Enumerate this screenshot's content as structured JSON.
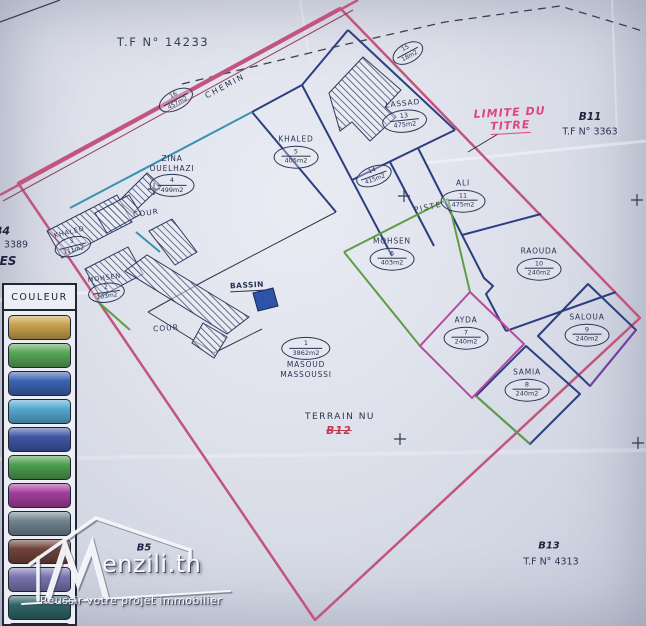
{
  "photo_labels": {
    "tf_main": "T.F N° 14233",
    "chemin": "CHEMIN",
    "limite_du_titre": [
      "LIMITE DU",
      "TITRE"
    ],
    "b11": "B11",
    "b11_tf": "T.F N° 3363",
    "b13": "B13",
    "b13_tf": "T.F N° 4313",
    "b5": "B5",
    "b4": "B4",
    "b4_tf": "3389",
    "left_partial": "ES",
    "piste": "PISTE",
    "cour_1": "COUR",
    "cour_2": "COUR",
    "bassin": "BASSIN",
    "terrain_nu": "TERRAIN NU",
    "b12": "B12"
  },
  "plots": [
    {
      "name": "",
      "number": "16",
      "area": "457m2"
    },
    {
      "name": "",
      "number": "15",
      "area": "18m2"
    },
    {
      "name": "LASSAD",
      "number": "13",
      "area": "475m2"
    },
    {
      "name": "",
      "number": "14",
      "area": "415m2"
    },
    {
      "name": "KHALED",
      "number": "5",
      "area": "405m2"
    },
    {
      "name": "ZINA",
      "name2": "OUELHAZI",
      "number": "4",
      "area": "499m2"
    },
    {
      "name": "ALI",
      "number": "11",
      "area": "475m2"
    },
    {
      "name": "RAOUDA",
      "number": "10",
      "area": "240m2"
    },
    {
      "name": "SALOUA",
      "number": "9",
      "area": "240m2"
    },
    {
      "name": "AYDA",
      "number": "7",
      "area": "240m2"
    },
    {
      "name": "SAMIA",
      "number": "8",
      "area": "240m2"
    },
    {
      "name": "MOHSEN",
      "number": "6",
      "area": "403m2"
    },
    {
      "name": "MASOUD",
      "name2": "MASSOUSSI",
      "number": "1",
      "area": "3862m2"
    },
    {
      "name": "KHALED",
      "number": "3",
      "area": "111m2"
    },
    {
      "name": "MOHSEN",
      "number": "2",
      "area": "103m2"
    }
  ],
  "legend": {
    "header": "COULEUR",
    "colors": [
      "#c8a24c",
      "#57a557",
      "#3c63b2",
      "#55a8cf",
      "#3f57a7",
      "#4d9d4f",
      "#a43e9d",
      "#70838f",
      "#6f4339",
      "#7a74b0",
      "#2f6668",
      "#275a3c"
    ]
  },
  "logo": {
    "brand_text": "enzili.tn",
    "slogan": "Réussir votre projet immobilier"
  },
  "colors": {
    "boundary_pink": "#c2557e",
    "boundary_inner": "#93405f",
    "navy": "#2b3f80",
    "green": "#5d9e45",
    "teal": "#3a92b0",
    "magenta": "#b84a9e",
    "purple": "#7b3fa3",
    "black_line": "#2f3545",
    "red_text": "#e0447c",
    "bassin_fill": "#2d54a8"
  }
}
